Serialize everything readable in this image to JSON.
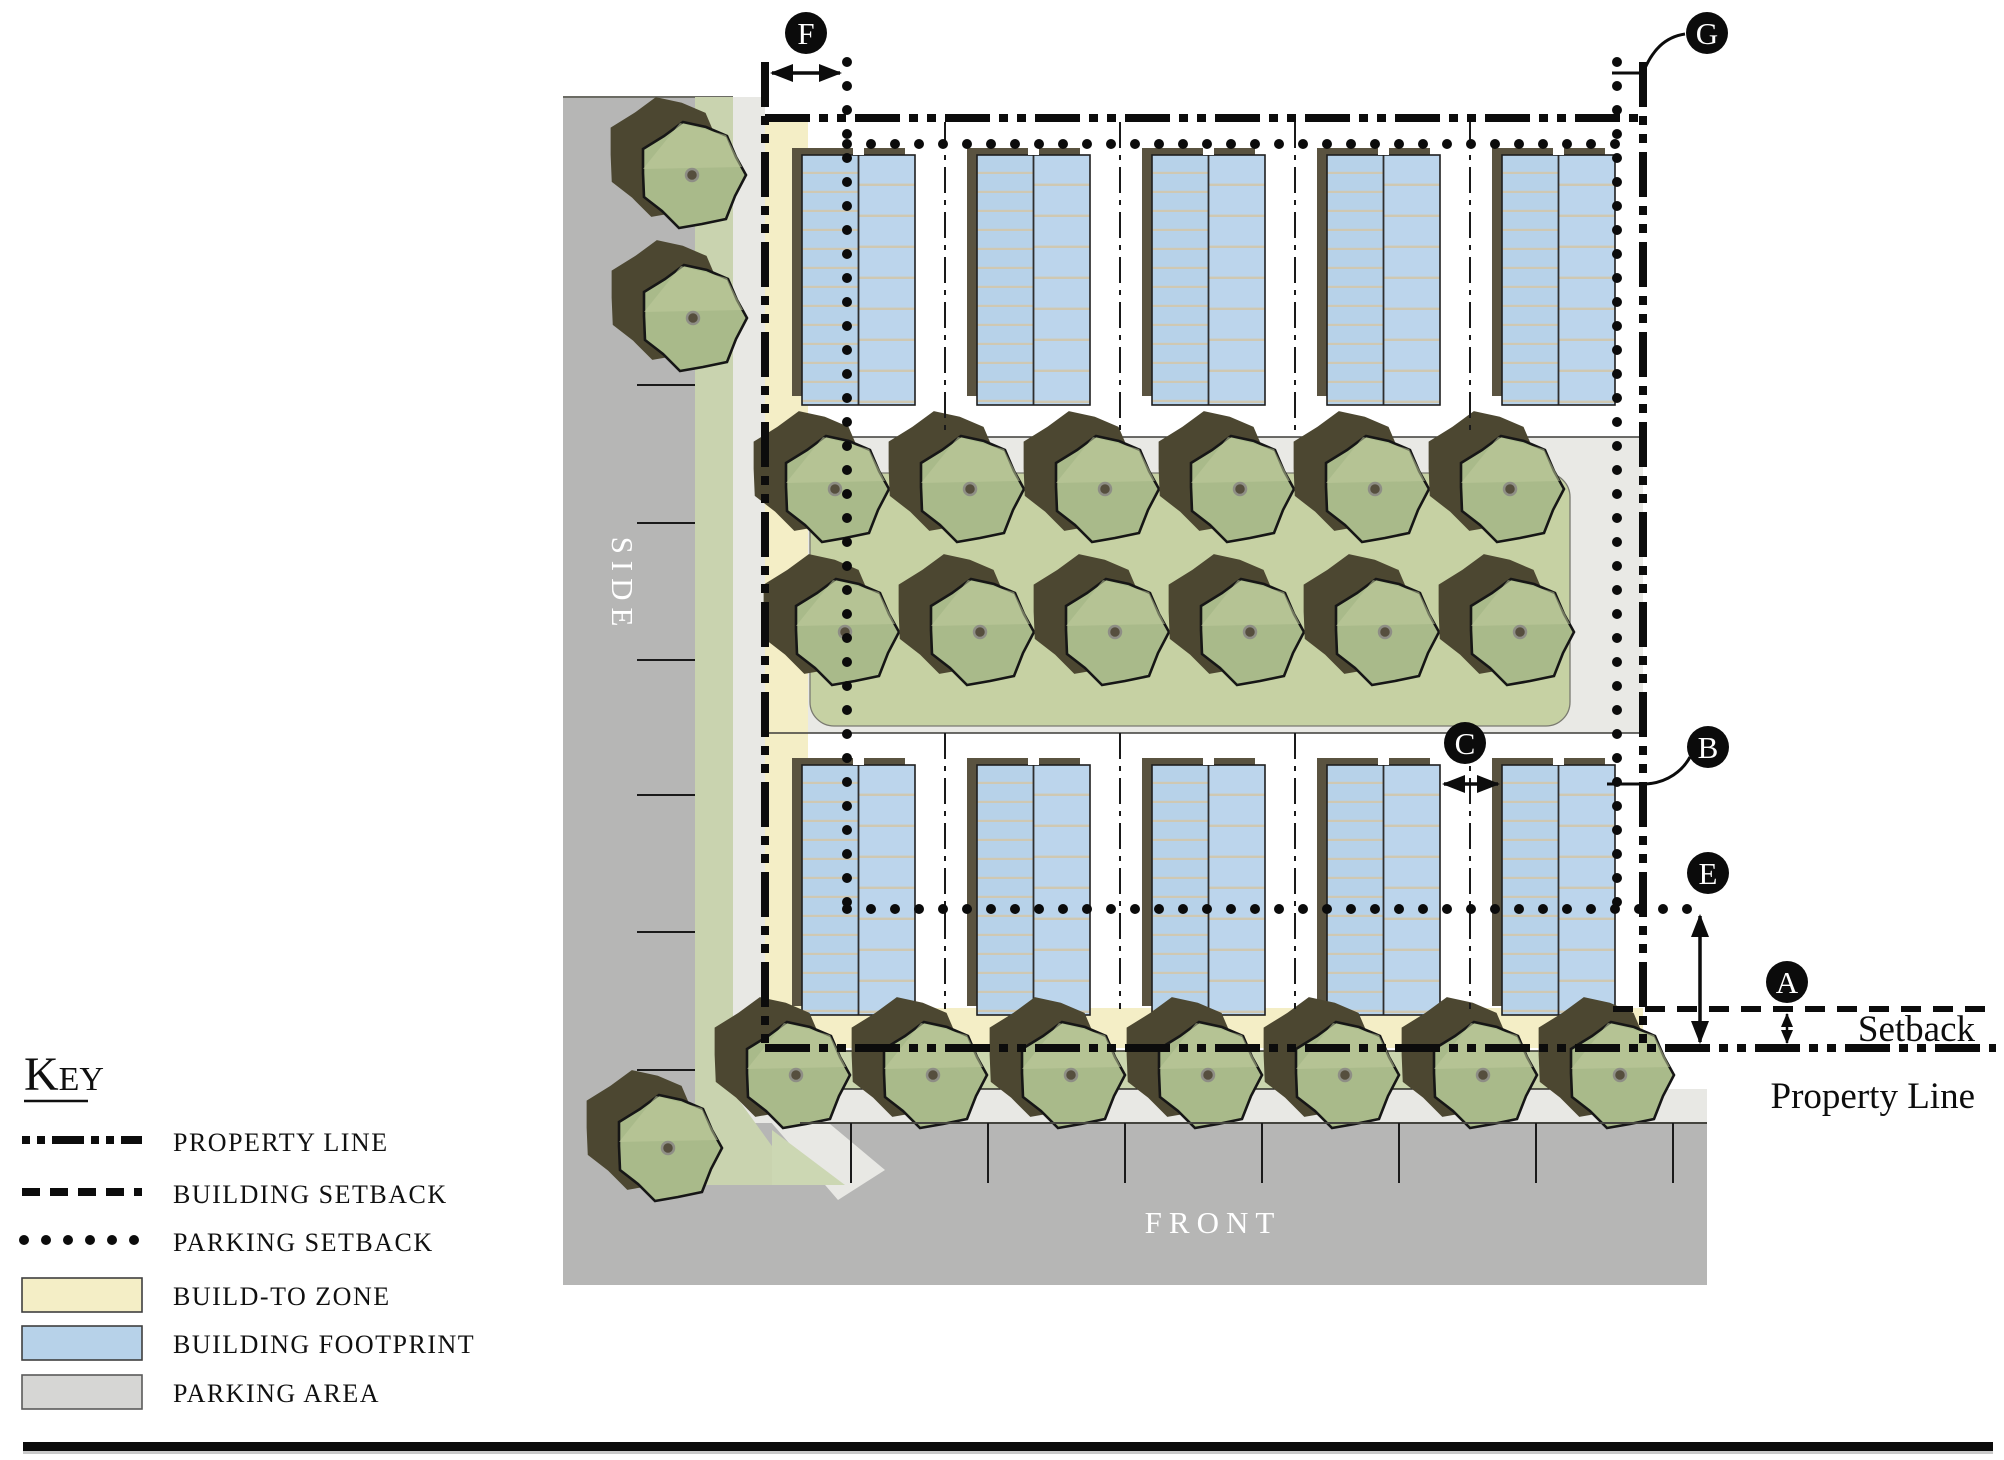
{
  "plan": {
    "side_street_label": "SIDE",
    "front_street_label": "FRONT",
    "setback_label": "Setback",
    "property_line_label": "Property Line",
    "markers": {
      "a": "A",
      "b": "B",
      "c": "C",
      "e": "E",
      "f": "F",
      "g": "G"
    }
  },
  "legend": {
    "title": "Key",
    "items": [
      {
        "label": "PROPERTY LINE"
      },
      {
        "label": "BUILDING SETBACK"
      },
      {
        "label": "PARKING SETBACK"
      },
      {
        "label": "BUILD-TO ZONE",
        "color": "#f4eec6"
      },
      {
        "label": "BUILDING FOOTPRINT",
        "color": "#b7d2e9"
      },
      {
        "label": "PARKING AREA",
        "color": "#d6d6d4"
      }
    ]
  },
  "colors": {
    "build_to_zone": "#f4eec6",
    "building_footprint": "#b7d2e9",
    "parking_area": "#b6b6b5",
    "lines": "#0c0c0c"
  }
}
